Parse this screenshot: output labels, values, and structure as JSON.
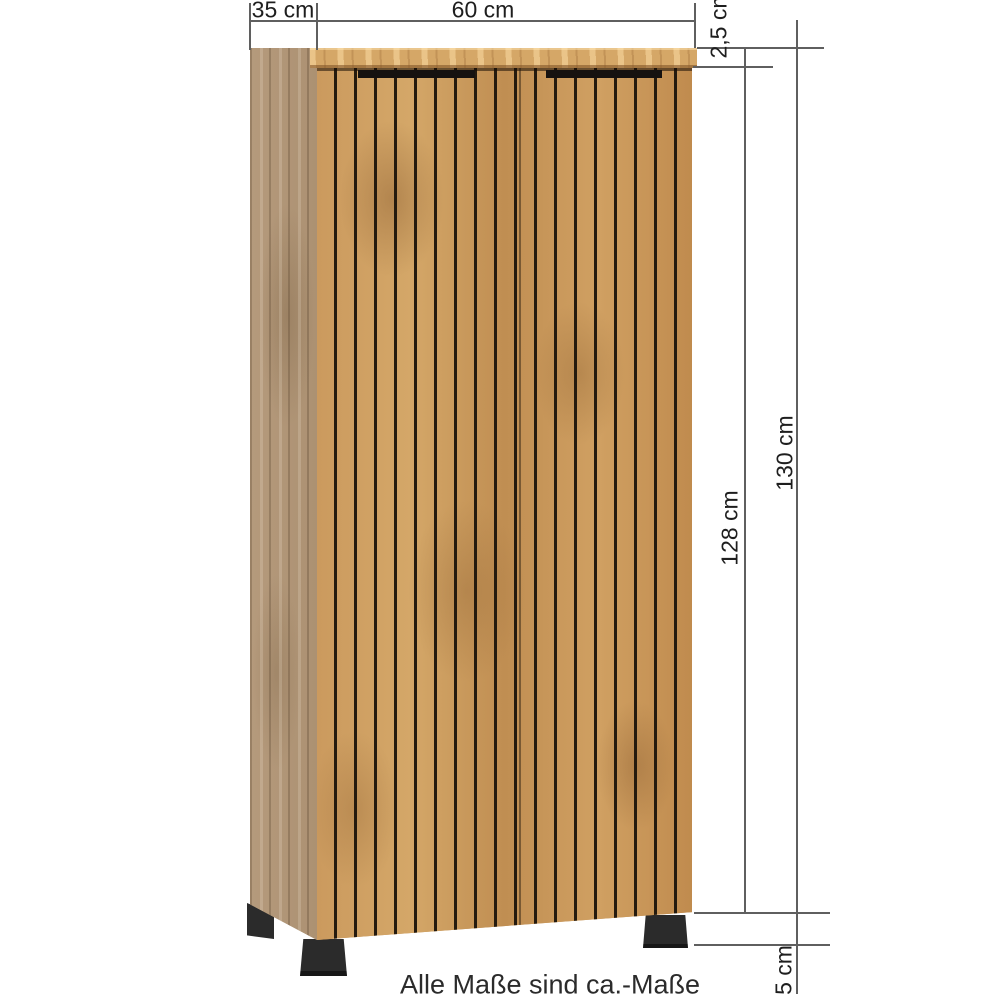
{
  "diagram": {
    "dimension_labels": {
      "depth": "35 cm",
      "width": "60 cm",
      "top_thickness": "2,5 cm",
      "body_height": "128 cm",
      "total_height": "130 cm",
      "feet_height": "5 cm"
    },
    "footnote": "Alle Maße sind ca.-Maße",
    "colors": {
      "wood_front": "#c6955a",
      "wood_side": "#b39878",
      "wood_top": "#d5a767",
      "groove": "#241a0e",
      "feet": "#2b2b2b",
      "line": "#5f5f5f",
      "text": "#1e1e1e",
      "background": "#ffffff"
    }
  }
}
